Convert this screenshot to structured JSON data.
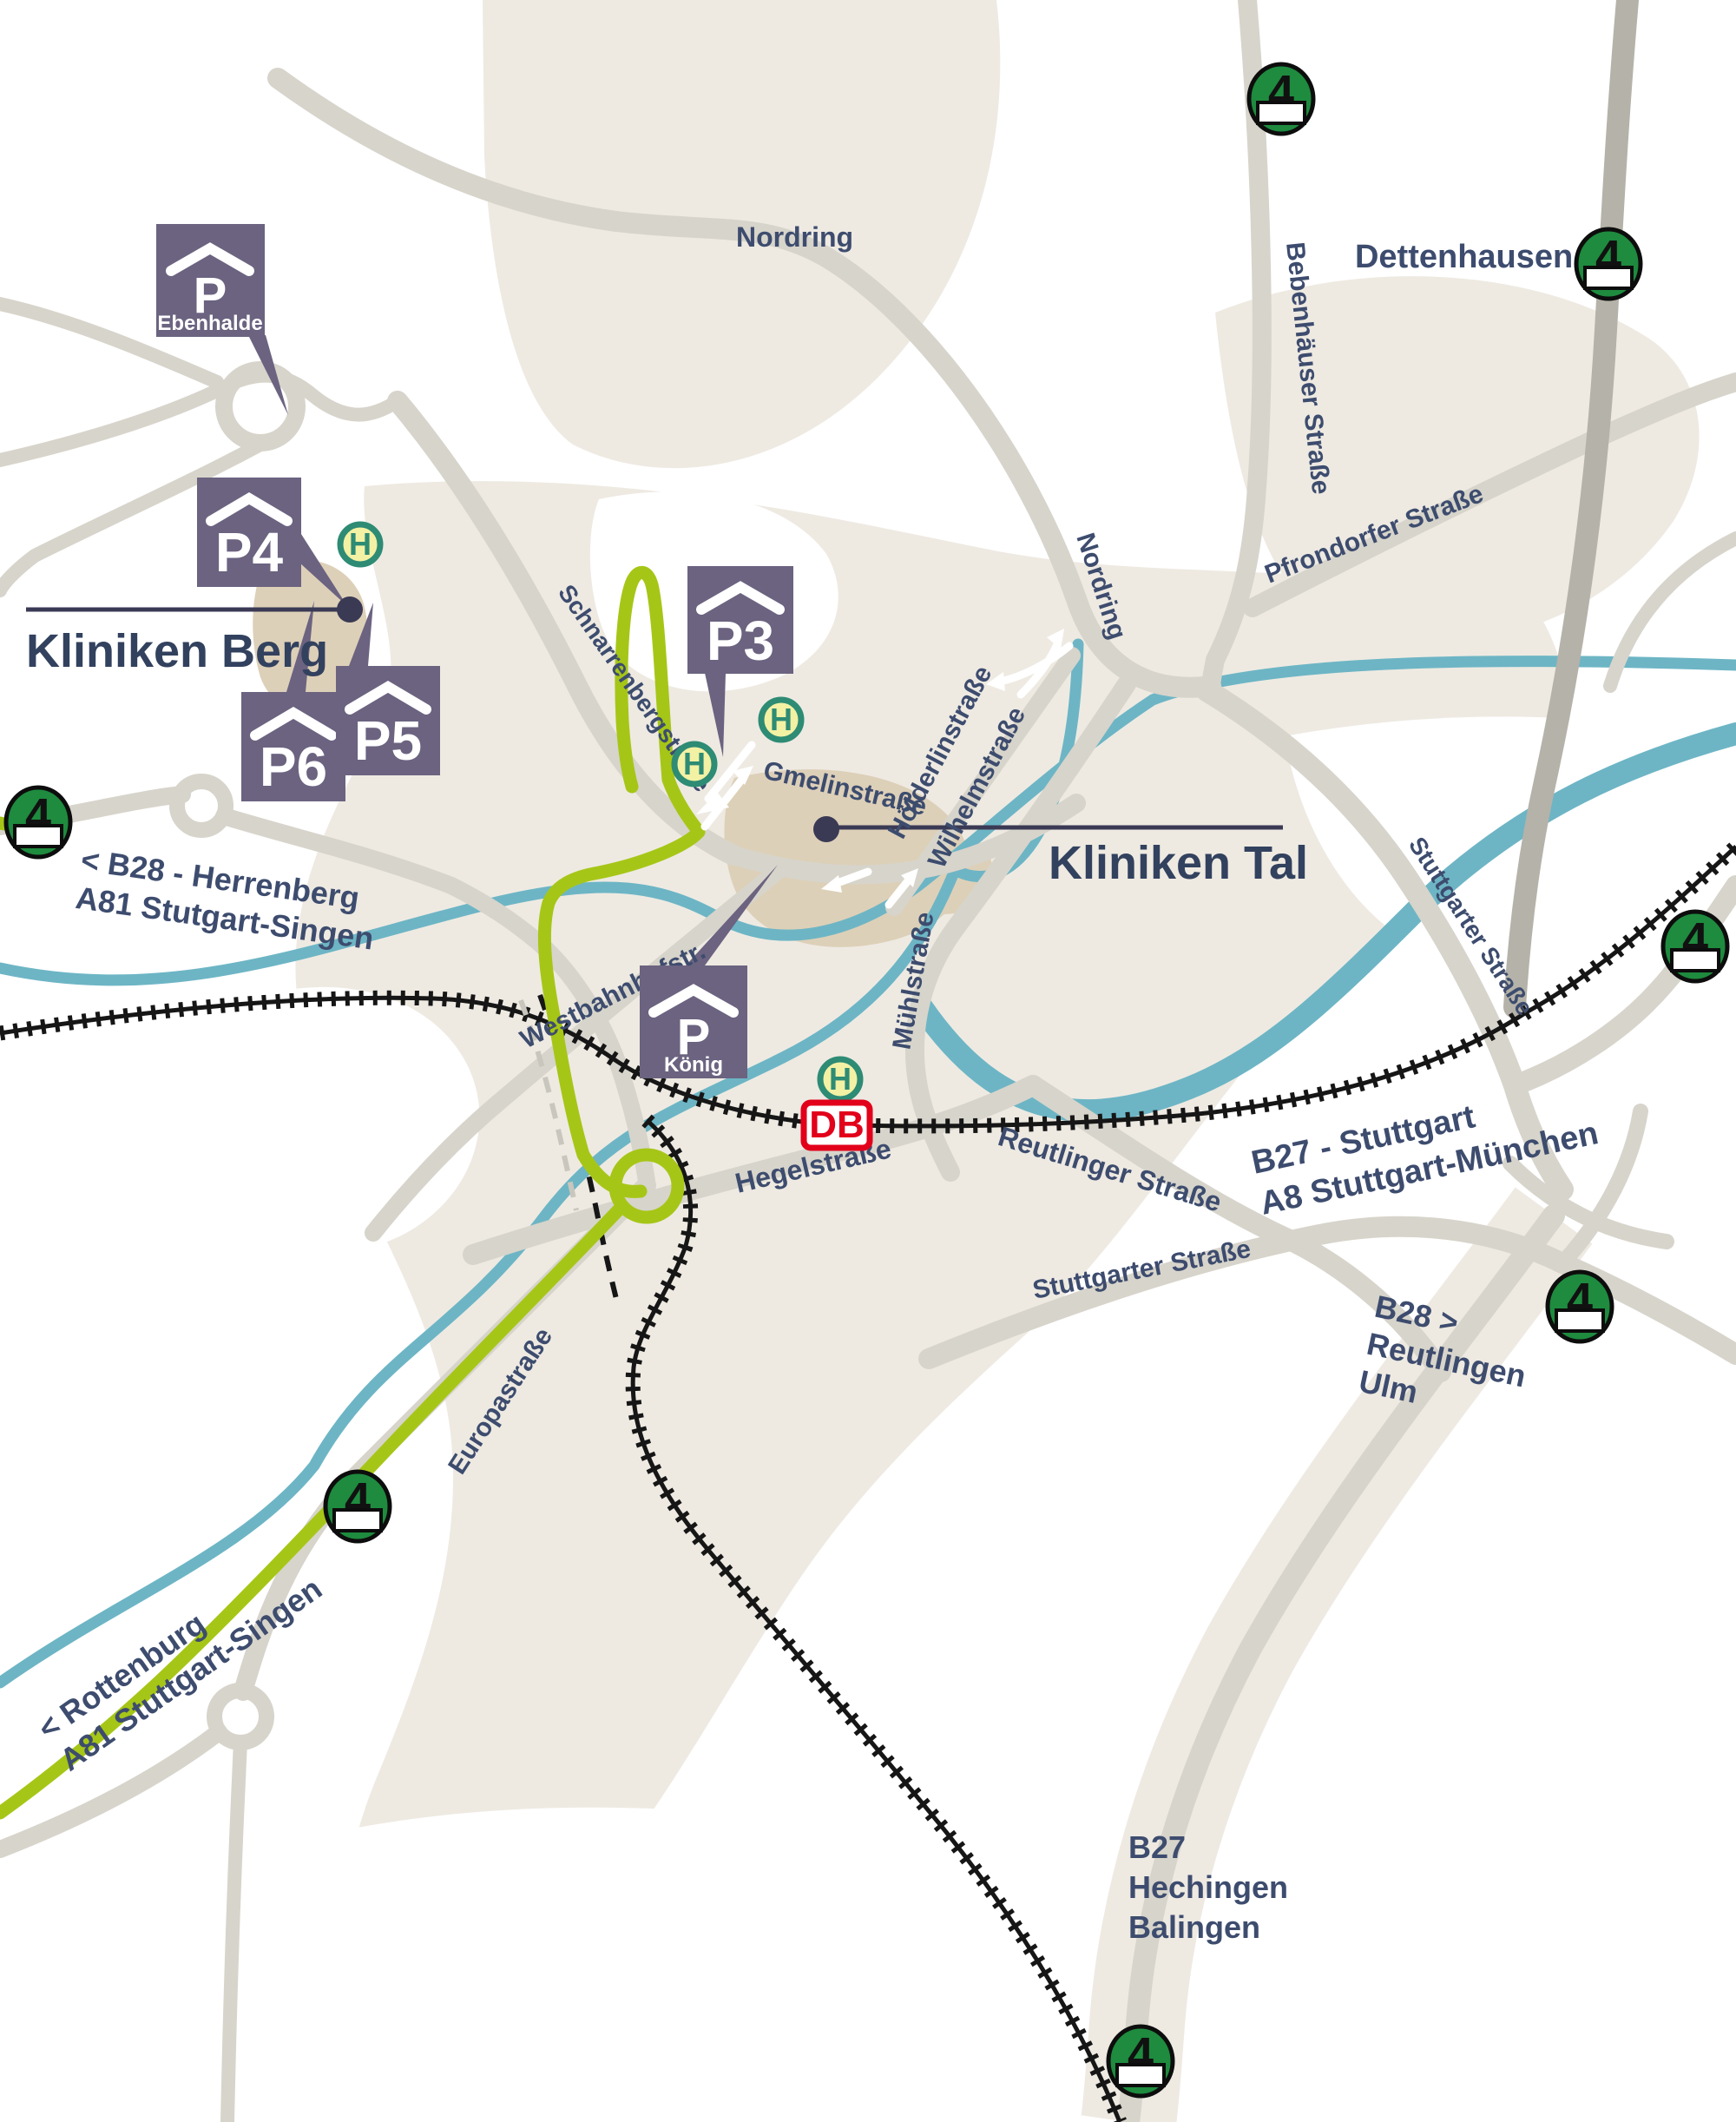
{
  "title": "Kliniken Tübingen Anfahrtsplan",
  "sites": {
    "kliniken_berg": "Kliniken Berg",
    "kliniken_tal": "Kliniken Tal"
  },
  "parking": {
    "ebenhalde": "Ebenhalde",
    "koenig": "König",
    "p3": "P3",
    "p4": "P4",
    "p5": "P5",
    "p6": "P6"
  },
  "transit": {
    "stop_letter": "H",
    "line_number": "4",
    "db_logo": "DB"
  },
  "streets": {
    "nordring": "Nordring",
    "bebenhaeuser": "Bebenhäuser Straße",
    "pfrondorfer": "Pfrondorfer Straße",
    "schnarrenberg": "Schnarrenbergstraße",
    "gmelin": "Gmelinstraße",
    "hoelderlin": "Hölderlinstraße",
    "wilhelm": "Wilhelmstraße",
    "muehl": "Mühlstraße",
    "westbahnhof": "Westbahnhofstr.",
    "hegel": "Hegelstraße",
    "reutlinger": "Reutlinger Straße",
    "stuttgarter": "Stuttgarter Straße",
    "europa": "Europastraße"
  },
  "destinations": {
    "dettenhausen": "Dettenhausen >",
    "b28_west": [
      "< B28 - Herrenberg",
      "A81 Stutgart-Singen"
    ],
    "rottenburg": [
      "< Rottenburg",
      "A81 Stuttgart-Singen"
    ],
    "b27_stuttgart": [
      "B27 - Stuttgart",
      "A8 Stuttgart-München"
    ],
    "b28_reutlingen": [
      "B28 >",
      "Reutlingen",
      "Ulm"
    ],
    "b27_hechingen": [
      "B27",
      "Hechingen",
      "Balingen"
    ]
  },
  "colors": {
    "route_green": "#a6c617",
    "parking_purple": "#6b6380",
    "river_blue": "#6db5c5",
    "badge_green": "#1e8b3e",
    "label_blue": "#3d4c6e",
    "db_red": "#e2001a"
  }
}
